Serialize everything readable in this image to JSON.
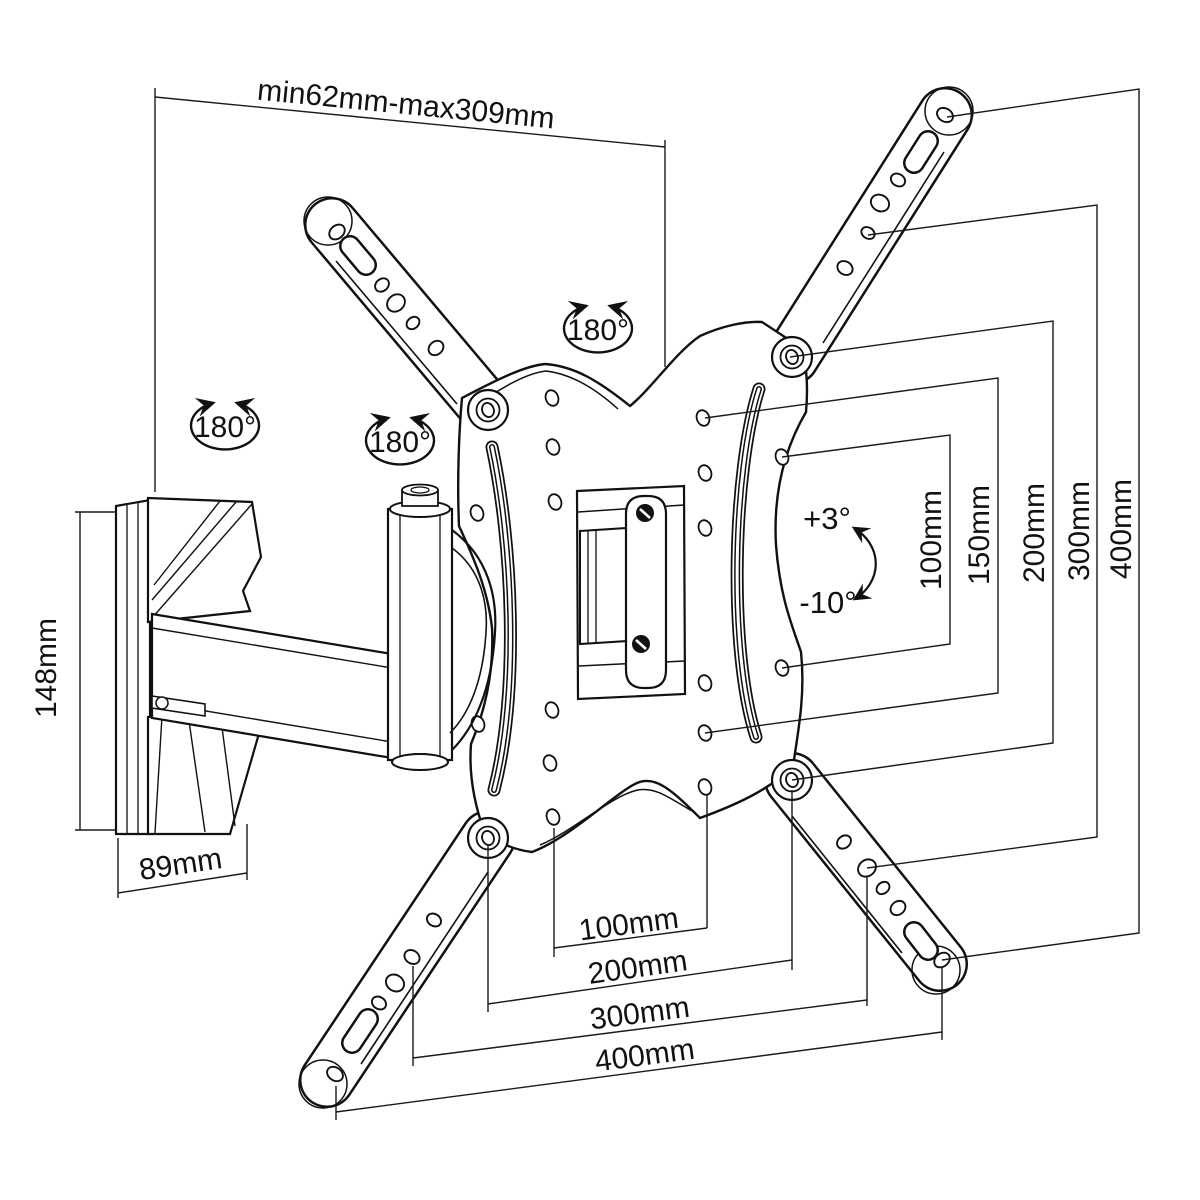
{
  "diagram": {
    "type": "technical-drawing",
    "subject": "full-motion TV wall mount bracket with VESA adapter plate",
    "line_color": "#111111",
    "background": "#ffffff",
    "labels": {
      "top_span": "min62mm-max309mm",
      "height_148": "148mm",
      "depth_89": "89mm",
      "rotation": [
        "180°",
        "180°",
        "180°"
      ],
      "tilt_up": "+3°",
      "tilt_down": "-10°",
      "bottom": [
        "100mm",
        "200mm",
        "300mm",
        "400mm"
      ],
      "right": [
        "100mm",
        "150mm",
        "200mm",
        "300mm",
        "400mm"
      ]
    }
  }
}
